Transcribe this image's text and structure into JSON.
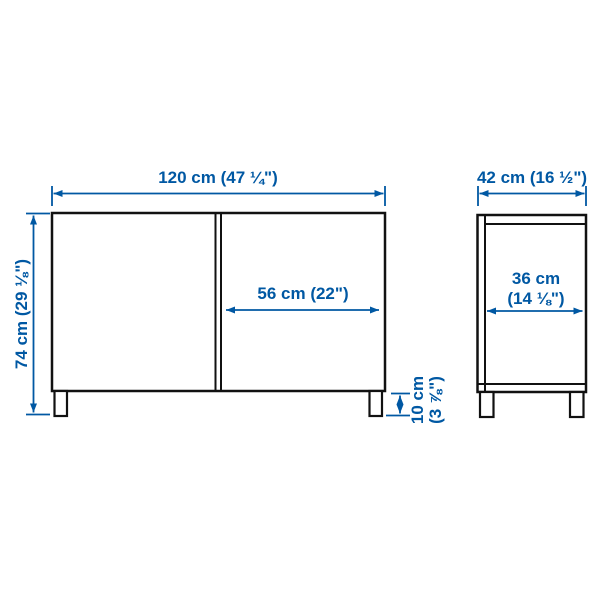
{
  "colors": {
    "accent": "#0058a3",
    "outline": "#111111",
    "background": "#ffffff"
  },
  "diagram": {
    "front_view": {
      "width_label": "120 cm (47 ¼\")",
      "height_label": "74 cm (29 ⅛\")",
      "door_width_label": "56 cm (22\")",
      "leg_height_label_line1": "10 cm",
      "leg_height_label_line2": "(3 ⅞\")"
    },
    "side_view": {
      "depth_label": "42 cm (16 ½\")",
      "inner_depth_label_line1": "36 cm",
      "inner_depth_label_line2": "(14 ⅛\")"
    }
  }
}
